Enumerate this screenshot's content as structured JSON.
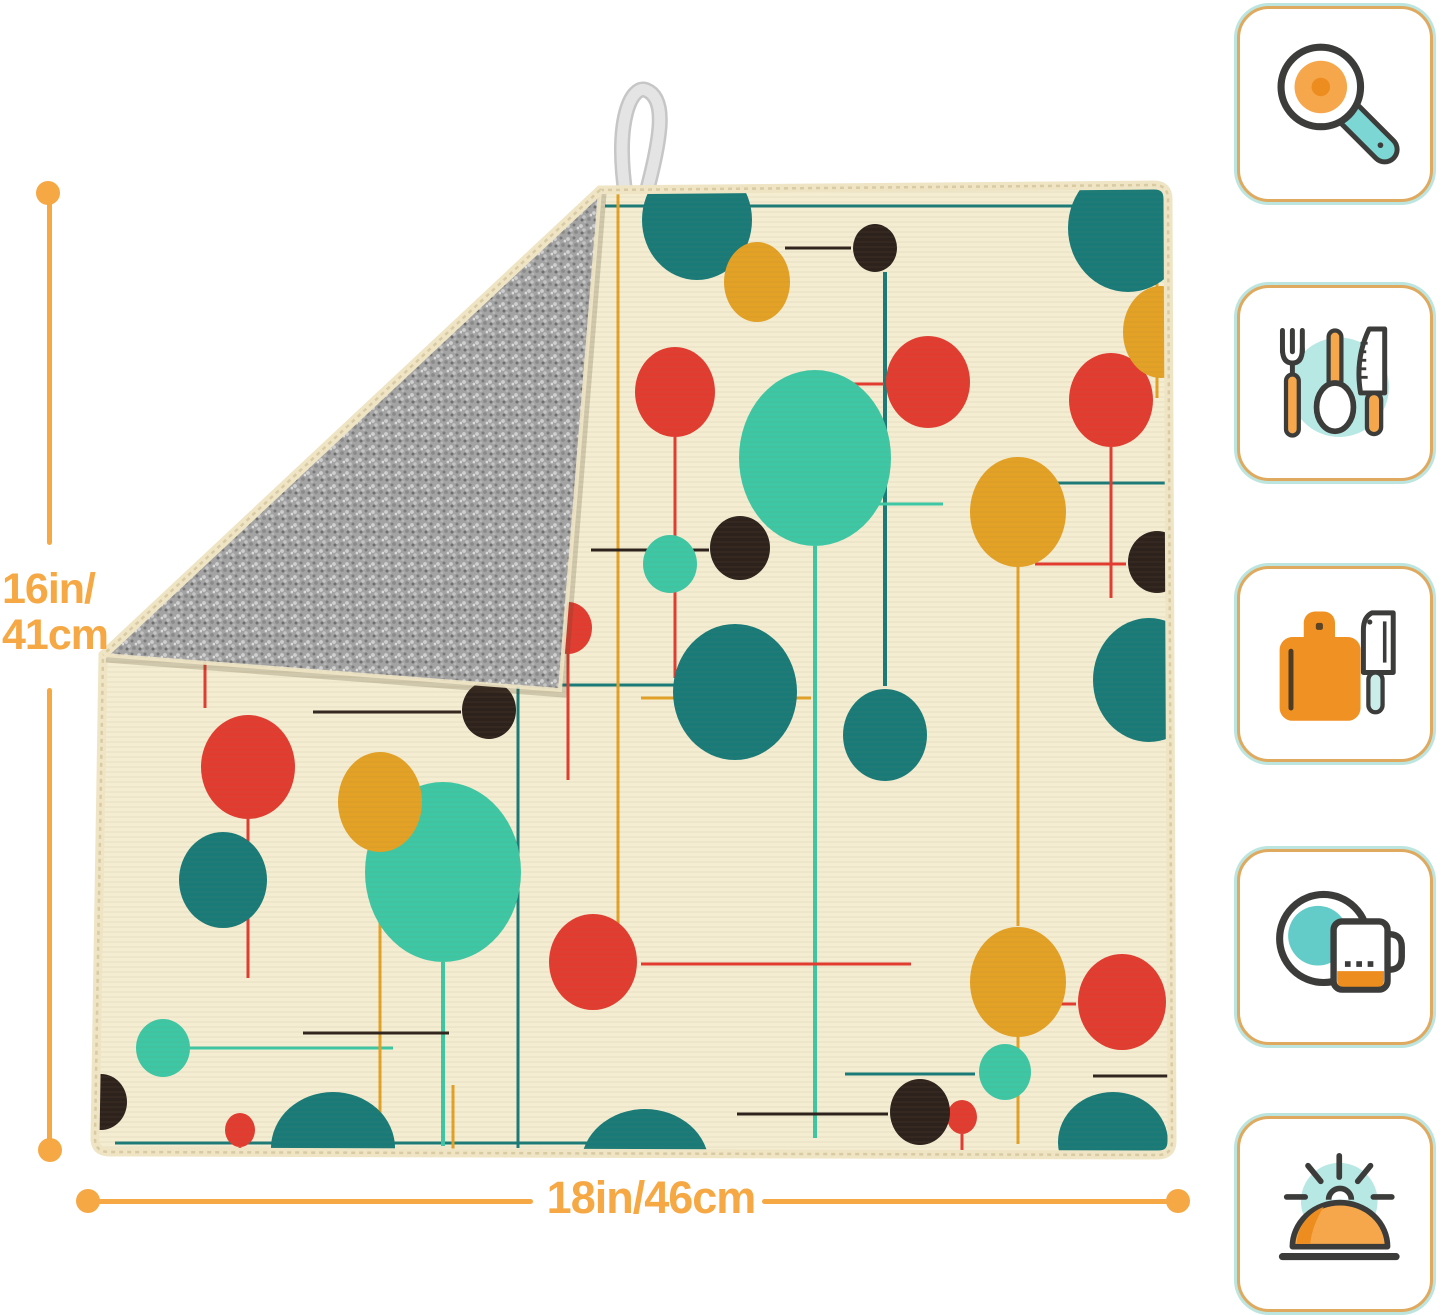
{
  "dimensions": {
    "height_label_line1": "16in/",
    "height_label_line2": "41cm",
    "width_label": "18in/46cm",
    "accent_color": "#F5A843"
  },
  "mat": {
    "front_color": "#F4EDD2",
    "binding_color": "#EFE5C5",
    "stitch_color": "#D8CBA4",
    "back_color": "#A3A3A3",
    "loop_color": "#E4E4E4",
    "palette": {
      "teal": "#1A7A77",
      "mint": "#3EC7A4",
      "red": "#E23B30",
      "mustard": "#E3A126",
      "black": "#2E221D"
    },
    "pattern": {
      "dots": [
        [
          "teal",
          612,
          140,
          55,
          60
        ],
        [
          "teal",
          1043,
          148,
          60,
          64
        ],
        [
          "teal",
          1064,
          600,
          56,
          62
        ],
        [
          "teal",
          650,
          612,
          62,
          68
        ],
        [
          "teal",
          800,
          655,
          42,
          46
        ],
        [
          "teal",
          138,
          800,
          44,
          48
        ],
        [
          "teal",
          248,
          1068,
          62,
          56
        ],
        [
          "teal",
          560,
          1085,
          64,
          56
        ],
        [
          "teal",
          1028,
          1062,
          55,
          50
        ],
        [
          "mint",
          730,
          378,
          76,
          88
        ],
        [
          "mint",
          358,
          792,
          78,
          90
        ],
        [
          "mint",
          585,
          484,
          27,
          29
        ],
        [
          "mint",
          78,
          968,
          27,
          29
        ],
        [
          "mint",
          920,
          992,
          26,
          28
        ],
        [
          "red",
          120,
          392,
          42,
          47
        ],
        [
          "red",
          590,
          312,
          40,
          45
        ],
        [
          "red",
          843,
          302,
          42,
          46
        ],
        [
          "red",
          1026,
          320,
          42,
          47
        ],
        [
          "red",
          163,
          687,
          47,
          52
        ],
        [
          "red",
          508,
          882,
          44,
          48
        ],
        [
          "red",
          1037,
          922,
          44,
          48
        ],
        [
          "red",
          483,
          548,
          24,
          26
        ],
        [
          "red",
          877,
          1037,
          15,
          17
        ],
        [
          "red",
          155,
          1050,
          15,
          17
        ],
        [
          "mustard",
          460,
          228,
          35,
          42
        ],
        [
          "mustard",
          672,
          202,
          33,
          40
        ],
        [
          "mustard",
          933,
          432,
          48,
          55
        ],
        [
          "mustard",
          933,
          902,
          48,
          55
        ],
        [
          "mustard",
          295,
          722,
          42,
          50
        ],
        [
          "mustard",
          1076,
          252,
          38,
          46
        ],
        [
          "black",
          790,
          168,
          22,
          24
        ],
        [
          "black",
          310,
          512,
          28,
          30
        ],
        [
          "black",
          655,
          468,
          30,
          32
        ],
        [
          "black",
          1072,
          482,
          29,
          31
        ],
        [
          "black",
          835,
          1032,
          30,
          33
        ],
        [
          "black",
          404,
          630,
          27,
          29
        ],
        [
          "black",
          16,
          1022,
          26,
          28
        ]
      ],
      "lines": [
        [
          "teal",
          520,
          126,
          1078,
          126,
          3
        ],
        [
          "teal",
          800,
          192,
          800,
          606,
          4
        ],
        [
          "teal",
          938,
          403,
          1082,
          403,
          3
        ],
        [
          "teal",
          433,
          588,
          433,
          1068,
          3
        ],
        [
          "teal",
          460,
          605,
          590,
          605,
          3
        ],
        [
          "teal",
          760,
          994,
          890,
          994,
          3
        ],
        [
          "teal",
          30,
          1063,
          558,
          1063,
          3
        ],
        [
          "mint",
          730,
          466,
          730,
          1058,
          4
        ],
        [
          "mint",
          358,
          882,
          358,
          1066,
          4
        ],
        [
          "mint",
          105,
          968,
          308,
          968,
          3
        ],
        [
          "mint",
          718,
          424,
          858,
          424,
          3
        ],
        [
          "red",
          120,
          439,
          120,
          628,
          3
        ],
        [
          "red",
          590,
          357,
          590,
          598,
          3
        ],
        [
          "red",
          700,
          304,
          799,
          304,
          3
        ],
        [
          "red",
          1026,
          367,
          1026,
          518,
          3
        ],
        [
          "red",
          950,
          484,
          1041,
          484,
          3
        ],
        [
          "red",
          163,
          739,
          163,
          898,
          3
        ],
        [
          "red",
          556,
          884,
          826,
          884,
          3
        ],
        [
          "red",
          892,
          924,
          991,
          924,
          3
        ],
        [
          "red",
          877,
          1054,
          877,
          1072,
          3
        ],
        [
          "red",
          483,
          574,
          483,
          700,
          3
        ],
        [
          "red",
          155,
          1067,
          155,
          1074,
          3
        ],
        [
          "mustard",
          460,
          112,
          460,
          186,
          3
        ],
        [
          "mustard",
          533,
          114,
          533,
          880,
          3
        ],
        [
          "mustard",
          933,
          487,
          933,
          846,
          3
        ],
        [
          "mustard",
          933,
          957,
          933,
          1064,
          3
        ],
        [
          "mustard",
          295,
          772,
          295,
          1066,
          3
        ],
        [
          "mustard",
          1072,
          112,
          1072,
          318,
          3
        ],
        [
          "mustard",
          368,
          1005,
          368,
          1070,
          3
        ],
        [
          "mustard",
          556,
          618,
          726,
          618,
          3
        ],
        [
          "black",
          700,
          168,
          766,
          168,
          3
        ],
        [
          "black",
          92,
          514,
          281,
          514,
          3
        ],
        [
          "black",
          506,
          470,
          624,
          470,
          3
        ],
        [
          "black",
          652,
          1034,
          803,
          1034,
          3
        ],
        [
          "black",
          228,
          632,
          376,
          632,
          3
        ],
        [
          "black",
          218,
          953,
          364,
          953,
          3
        ],
        [
          "black",
          1008,
          996,
          1084,
          996,
          3
        ]
      ]
    }
  },
  "icons": [
    {
      "name": "frying-pan-icon"
    },
    {
      "name": "utensils-icon"
    },
    {
      "name": "cutting-board-icon"
    },
    {
      "name": "plate-and-mug-icon"
    },
    {
      "name": "serving-cloche-icon"
    }
  ],
  "icon_card": {
    "background": "#FFFFFF",
    "outer_border": "#BCE5DF",
    "inner_border": "#DFA95F",
    "stroke": "#3C3C3B",
    "orange": "#F6A74B",
    "deep_orange": "#EE8D1F",
    "teal_light": "#7CD6D3",
    "pale_teal": "#B7E8E4",
    "board_orange": "#F09123",
    "pale_handle": "#CBEDEA",
    "plate_teal": "#63CCC9"
  }
}
